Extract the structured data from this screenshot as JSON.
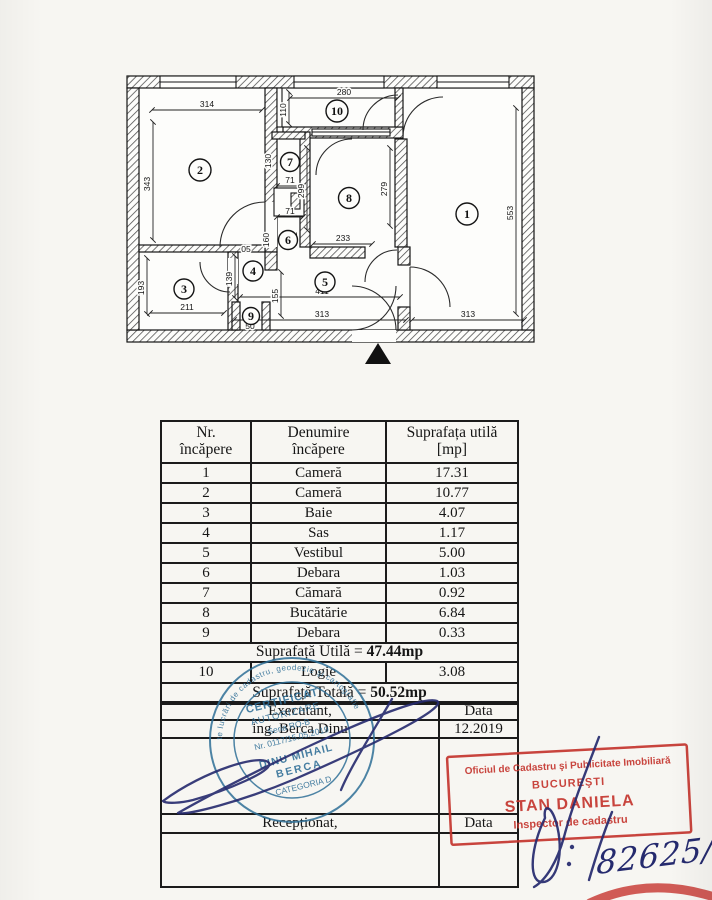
{
  "plan": {
    "rooms": [
      "1",
      "2",
      "3",
      "4",
      "5",
      "6",
      "7",
      "8",
      "9",
      "10"
    ],
    "dims": {
      "w314": "314",
      "h343": "343",
      "h193": "193",
      "w211": "211",
      "w280": "280",
      "h110": "110",
      "w71a": "71",
      "w71b": "71",
      "h130": "130",
      "h299": "299",
      "h279": "279",
      "w233": "233",
      "h553": "553",
      "w313a": "313",
      "w313b": "313",
      "w411": "411",
      "h155": "155",
      "h139": "139",
      "w05": "05",
      "h160": "160",
      "h131": "131",
      "w50": "50"
    }
  },
  "table": {
    "header": {
      "c1a": "Nr.",
      "c1b": "încăpere",
      "c2a": "Denumire",
      "c2b": "încăpere",
      "c3a": "Suprafața utilă",
      "c3b": "[mp]"
    },
    "rows": [
      {
        "nr": "1",
        "name": "Cameră",
        "area": "17.31"
      },
      {
        "nr": "2",
        "name": "Cameră",
        "area": "10.77"
      },
      {
        "nr": "3",
        "name": "Baie",
        "area": "4.07"
      },
      {
        "nr": "4",
        "name": "Sas",
        "area": "1.17"
      },
      {
        "nr": "5",
        "name": "Vestibul",
        "area": "5.00"
      },
      {
        "nr": "6",
        "name": "Debara",
        "area": "1.03"
      },
      {
        "nr": "7",
        "name": "Cămară",
        "area": "0.92"
      },
      {
        "nr": "8",
        "name": "Bucătărie",
        "area": "6.84"
      },
      {
        "nr": "9",
        "name": "Debara",
        "area": "0.33"
      }
    ],
    "utila_label": "Suprafață Utilă = ",
    "utila_value": "47.44mp",
    "row10": {
      "nr": "10",
      "name": "Logie",
      "area": "3.08"
    },
    "totala_label": "Suprafață Totală = ",
    "totala_value": "50.52mp",
    "executant_label": "Executant,",
    "executant_name": "ing. Berca Dinu",
    "data_label": "Data",
    "data_value": "12.2019",
    "receptionat_label": "Recepționat,",
    "data_label2": "Data"
  },
  "stamps": {
    "round": {
      "color": "#2e6e96",
      "ring": "persoană fizică autorizată de ANCPI să execute lucrări de cadastru, geodezie şi cartografie",
      "l1": "CERTIFICAT",
      "l2": "AUTORIZARE",
      "l3": "Seria RO-B",
      "l4": "Nr. 0117/15.05.2019",
      "l5": "DINU MIHAIL",
      "l6": "BERCA",
      "l7": "CATEGORIA D"
    },
    "red": {
      "color": "#c5352e",
      "l1": "Oficiul de Cadastru şi Publicitate Imobiliară",
      "l2": "BUCUREŞTI",
      "l3": "STAN DANIELA",
      "l4": "Inspector de cadastru"
    },
    "handwriting": {
      "number": "82625/2019",
      "ink": "#252a6e"
    }
  }
}
